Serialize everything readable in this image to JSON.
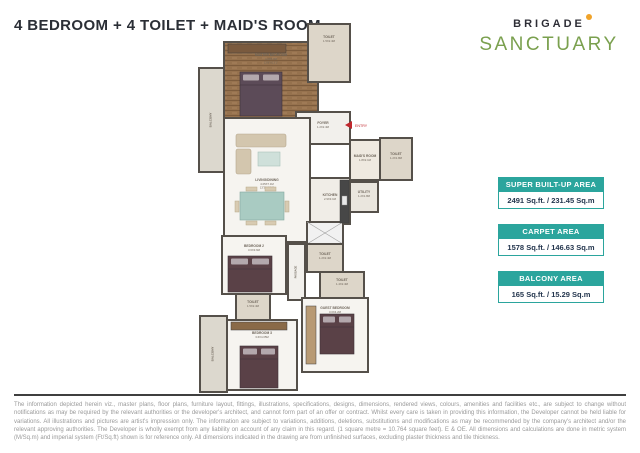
{
  "header": {
    "title": "4 BEDROOM + 4 TOILET + MAID'S ROOM"
  },
  "logo": {
    "brand": "BRIGADE",
    "project": "SANCTUARY"
  },
  "colors": {
    "teal": "#2ba59d",
    "navy": "#24364e",
    "entry_red": "#c0272d",
    "logo_green": "#7aa04e",
    "logo_dot": "#f0a32a",
    "wall": "#55504a"
  },
  "area_cards": [
    {
      "label": "SUPER BUILT-UP AREA",
      "value": "2491 Sq.ft. / 231.45 Sq.m"
    },
    {
      "label": "CARPET AREA",
      "value": "1578 Sq.ft. / 146.63 Sq.m"
    },
    {
      "label": "BALCONY AREA",
      "value": "165 Sq.ft. / 15.29 Sq.m"
    }
  ],
  "floorplan": {
    "entry_label": "ENTRY",
    "rooms": [
      {
        "id": "balcony-master",
        "x": 199,
        "y": 68,
        "w": 25,
        "h": 104,
        "fill": "#dcd8ce",
        "lines": [
          "BALCONY"
        ],
        "vertical": true,
        "fs": 3
      },
      {
        "id": "master-bedroom",
        "x": 224,
        "y": 42,
        "w": 94,
        "h": 76,
        "fill": "wood",
        "lines": [
          "MASTER BEDROOM",
          "4.2X4.0M",
          "13'9\"X13'1\""
        ],
        "label_y": 56
      },
      {
        "id": "toilet-master",
        "x": 308,
        "y": 24,
        "w": 42,
        "h": 58,
        "fill": "#ddd6c9",
        "lines": [
          "TOILET",
          "1.5X2.4M"
        ],
        "label_y": 38
      },
      {
        "id": "foyer",
        "x": 296,
        "y": 112,
        "w": 54,
        "h": 32,
        "fill": "#f2f0ec",
        "lines": [
          "FOYER",
          "1.2X2.4M"
        ],
        "label_y": 124
      },
      {
        "id": "living-dining",
        "x": 224,
        "y": 118,
        "w": 86,
        "h": 124,
        "fill": "#f6f4f0",
        "lines": [
          "LIVING/DINING",
          "4.05X7.1M",
          "13'3\"X23'4\""
        ],
        "label_y": 181
      },
      {
        "id": "kitchen",
        "x": 310,
        "y": 178,
        "w": 40,
        "h": 46,
        "fill": "#f0ede7",
        "lines": [
          "KITCHEN",
          "2.9X3.1M"
        ],
        "label_y": 196
      },
      {
        "id": "maids-room",
        "x": 350,
        "y": 140,
        "w": 30,
        "h": 40,
        "fill": "#efe9e0",
        "lines": [
          "MAID'S ROOM",
          "1.8X2.1M"
        ],
        "label_y": 157
      },
      {
        "id": "toilet-maid",
        "x": 380,
        "y": 138,
        "w": 32,
        "h": 42,
        "fill": "#ddd6c9",
        "lines": [
          "TOILET",
          "1.2X1.8M"
        ],
        "label_y": 155
      },
      {
        "id": "utility",
        "x": 350,
        "y": 182,
        "w": 28,
        "h": 30,
        "fill": "#eae6de",
        "lines": [
          "UTILITY",
          "1.2X1.8M"
        ],
        "label_y": 193
      },
      {
        "id": "lobby-hatch",
        "x": 307,
        "y": 222,
        "w": 36,
        "h": 22,
        "fill": "#f1f1f1",
        "hatch": true
      },
      {
        "id": "toilet-common",
        "x": 307,
        "y": 244,
        "w": 36,
        "h": 28,
        "fill": "#ddd6c9",
        "lines": [
          "TOILET",
          "1.2X2.4M"
        ],
        "label_y": 255
      },
      {
        "id": "passage",
        "x": 288,
        "y": 244,
        "w": 17,
        "h": 56,
        "fill": "#f2f0ec",
        "lines": [
          "PASSAGE"
        ],
        "vertical": true,
        "fs": 2.6
      },
      {
        "id": "bedroom-2",
        "x": 222,
        "y": 236,
        "w": 64,
        "h": 58,
        "fill": "#f6f4f0",
        "lines": [
          "BEDROOM 2",
          "3.6X3.6M"
        ],
        "label_y": 247
      },
      {
        "id": "toilet-2",
        "x": 236,
        "y": 294,
        "w": 34,
        "h": 26,
        "fill": "#ddd6c9",
        "lines": [
          "TOILET",
          "1.5X2.4M"
        ],
        "label_y": 303
      },
      {
        "id": "balcony-bottom",
        "x": 200,
        "y": 316,
        "w": 27,
        "h": 76,
        "fill": "#dcd8ce",
        "lines": [
          "BALCONY"
        ],
        "vertical": true,
        "fs": 3
      },
      {
        "id": "bedroom-3",
        "x": 227,
        "y": 320,
        "w": 70,
        "h": 70,
        "fill": "#f6f4f0",
        "lines": [
          "BEDROOM 3",
          "3.6X4.05M"
        ],
        "label_y": 334
      },
      {
        "id": "toilet-3",
        "x": 320,
        "y": 272,
        "w": 44,
        "h": 26,
        "fill": "#ddd6c9",
        "lines": [
          "TOILET",
          "1.4X2.4M"
        ],
        "label_y": 281
      },
      {
        "id": "guest-bedroom",
        "x": 302,
        "y": 298,
        "w": 66,
        "h": 74,
        "fill": "#f6f4f0",
        "lines": [
          "GUEST BEDROOM",
          "3.0X4.2M"
        ],
        "label_y": 309
      }
    ],
    "furniture": [
      {
        "type": "wardrobe",
        "x": 228,
        "y": 44,
        "w": 58,
        "h": 9,
        "fill": "#7a5a3e"
      },
      {
        "type": "bed",
        "x": 240,
        "y": 72,
        "w": 42,
        "h": 44,
        "fill": "#5c4b58"
      },
      {
        "type": "sofa",
        "x": 236,
        "y": 134,
        "w": 50,
        "h": 40,
        "fill": "#d3c6ae"
      },
      {
        "type": "table",
        "x": 240,
        "y": 192,
        "w": 44,
        "h": 28,
        "fill": "#a9cbc2"
      },
      {
        "type": "counter",
        "x": 340,
        "y": 180,
        "w": 9,
        "h": 43,
        "fill": "#474747"
      },
      {
        "type": "bed",
        "x": 228,
        "y": 256,
        "w": 44,
        "h": 36,
        "fill": "#5a4147"
      },
      {
        "type": "wardrobe",
        "x": 231,
        "y": 322,
        "w": 56,
        "h": 8,
        "fill": "#8a6a48"
      },
      {
        "type": "bed",
        "x": 240,
        "y": 346,
        "w": 38,
        "h": 42,
        "fill": "#5a4147"
      },
      {
        "type": "wardrobe",
        "x": 306,
        "y": 306,
        "w": 10,
        "h": 58,
        "fill": "#b89a74"
      },
      {
        "type": "bed",
        "x": 320,
        "y": 314,
        "w": 34,
        "h": 40,
        "fill": "#5a4147"
      }
    ]
  },
  "disclaimer": "The information depicted herein viz., master plans, floor plans, furniture layout, fittings, illustrations, specifications, designs, dimensions, rendered views, colours, amenities and facilities etc., are subject to change without notifications as may be required by the relevant authorities or the developer's architect, and cannot form part of an offer or contract. Whilst every care is taken in providing this information, the Developer cannot be held liable for variations. All illustrations and pictures are artist's impression only. The information are subject to variations, additions, deletions, substitutions and modifications as may be recommended by the company's architect and/or the relevant approving authorities. The Developer is wholly exempt from any liability on account of any claim in this regard. (1 square metre = 10.764 square feet). E & OE. All dimensions and calculations are done in metric system (M/Sq.m) and imperial system (Ft/Sq.ft) shown is for reference only. All dimensions indicated in the drawing are from unfinished surfaces, excluding plaster thickness and tile thickness."
}
